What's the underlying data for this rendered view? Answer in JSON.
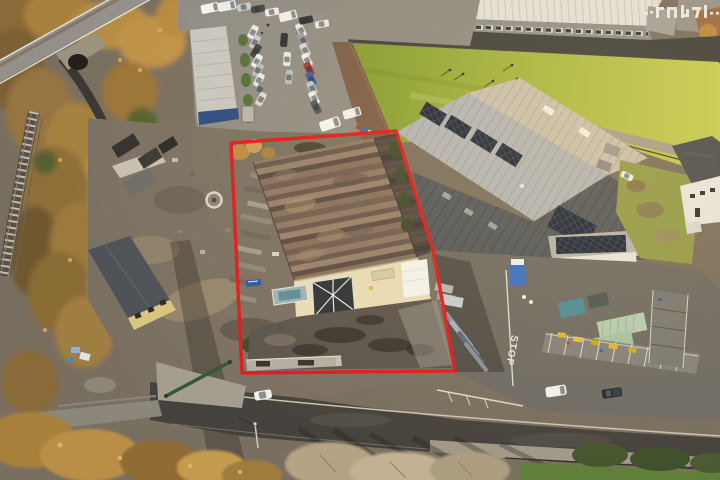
{
  "scene": {
    "type": "aerial-drone-photograph",
    "subject": "industrial warehouse premises outlined in red",
    "stop_marking": "STOP"
  },
  "annotation": {
    "color": "#e2191c",
    "stroke_width": 3.5,
    "points": "231,143 396,131 433,250 455,371 242,373"
  },
  "watermark": {
    "legible": false,
    "glyph_blocks": 5,
    "color": "#f5f3ef"
  },
  "palette": {
    "boundary_red": "#e2191c",
    "field_grass_light": "#c6ce55",
    "field_grass_dark": "#7f9830",
    "subject_roof_brown": "#7e695b",
    "neighbour_roof_grey": "#b3b6b8",
    "solar_panel": "#1f2734",
    "facade_cream": "#e8dcb8",
    "tarmac": "#55514b",
    "road": "#45423d",
    "autumn_tree_gold": "#b68c42",
    "container_green": "#b6cdb1"
  }
}
